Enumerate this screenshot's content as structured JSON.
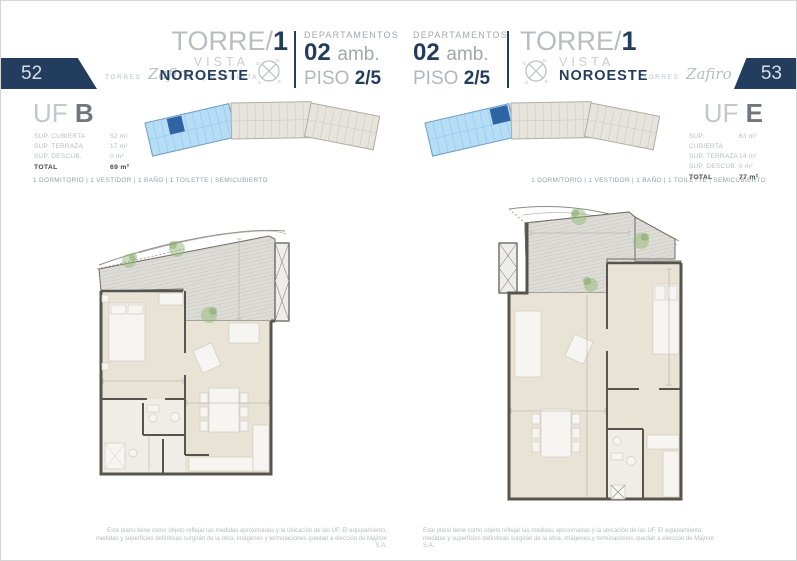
{
  "colors": {
    "navy": "#233d5e",
    "unit_highlight_blue": "#2e64a4",
    "segment_light_blue": "#b5ddf5",
    "plan_wall": "#57544c",
    "plan_floor": "#e9e3d6"
  },
  "brand": {
    "torres": "TORRES",
    "zafiro": "Zafiro",
    "separator": "|",
    "nordelta": "NORDELTA"
  },
  "compass": {
    "n": "N",
    "o": "O",
    "s": "S",
    "e": "E"
  },
  "left_page": {
    "page_number": "52",
    "tower": {
      "name": "TORRE/",
      "number": "1",
      "vista": "VISTA",
      "orientation": "NOROESTE"
    },
    "departamentos": {
      "label": "DEPARTAMENTOS",
      "count": "02",
      "amb": "amb.",
      "piso": "PISO",
      "piso_value": "2/5"
    },
    "unit": {
      "uf": "UF",
      "letter": "B",
      "specs": [
        {
          "label": "SUP. CUBIERTA",
          "value": "52 m²"
        },
        {
          "label": "SUP. TERRAZA",
          "value": "17 m²"
        },
        {
          "label": "SUP. DESCUB.",
          "value": "0 m²"
        }
      ],
      "total_label": "TOTAL",
      "total_value": "69 m²",
      "features": "1 DORMITORIO | 1 VESTIDOR | 1 BAÑO | 1 TOILETTE | SEMICUBIERTO"
    },
    "disclaimer": {
      "line1": "Este plano tiene como objeto reflejar las medidas aproximadas y la ubicación de las UF. El equipamiento,",
      "line2": "medidas y superficies definitivas surgirán de la obra, imágenes y terminaciones quedan a elección de Majmor S.A."
    }
  },
  "right_page": {
    "page_number": "53",
    "tower": {
      "name": "TORRE/",
      "number": "1",
      "vista": "VISTA",
      "orientation": "NOROESTE"
    },
    "departamentos": {
      "label": "DEPARTAMENTOS",
      "count": "02",
      "amb": "amb.",
      "piso": "PISO",
      "piso_value": "2/5"
    },
    "unit": {
      "uf": "UF",
      "letter": "E",
      "specs": [
        {
          "label": "SUP. CUBIERTA",
          "value": "63 m²"
        },
        {
          "label": "SUP. TERRAZA",
          "value": "14 m²"
        },
        {
          "label": "SUP. DESCUB.",
          "value": "0 m²"
        }
      ],
      "total_label": "TOTAL",
      "total_value": "77 m²",
      "features": "1 DORMITORIO | 1 VESTIDOR | 1 BAÑO | 1 TOILETTE | SEMICUBIERTO"
    },
    "disclaimer": {
      "line1": "Este plano tiene como objeto reflejar las medidas aproximadas y la ubicación de las UF. El equipamiento,",
      "line2": "medidas y superficies definitivas surgirán de la obra, imágenes y terminaciones quedan a elección de Majmor S.A."
    }
  }
}
